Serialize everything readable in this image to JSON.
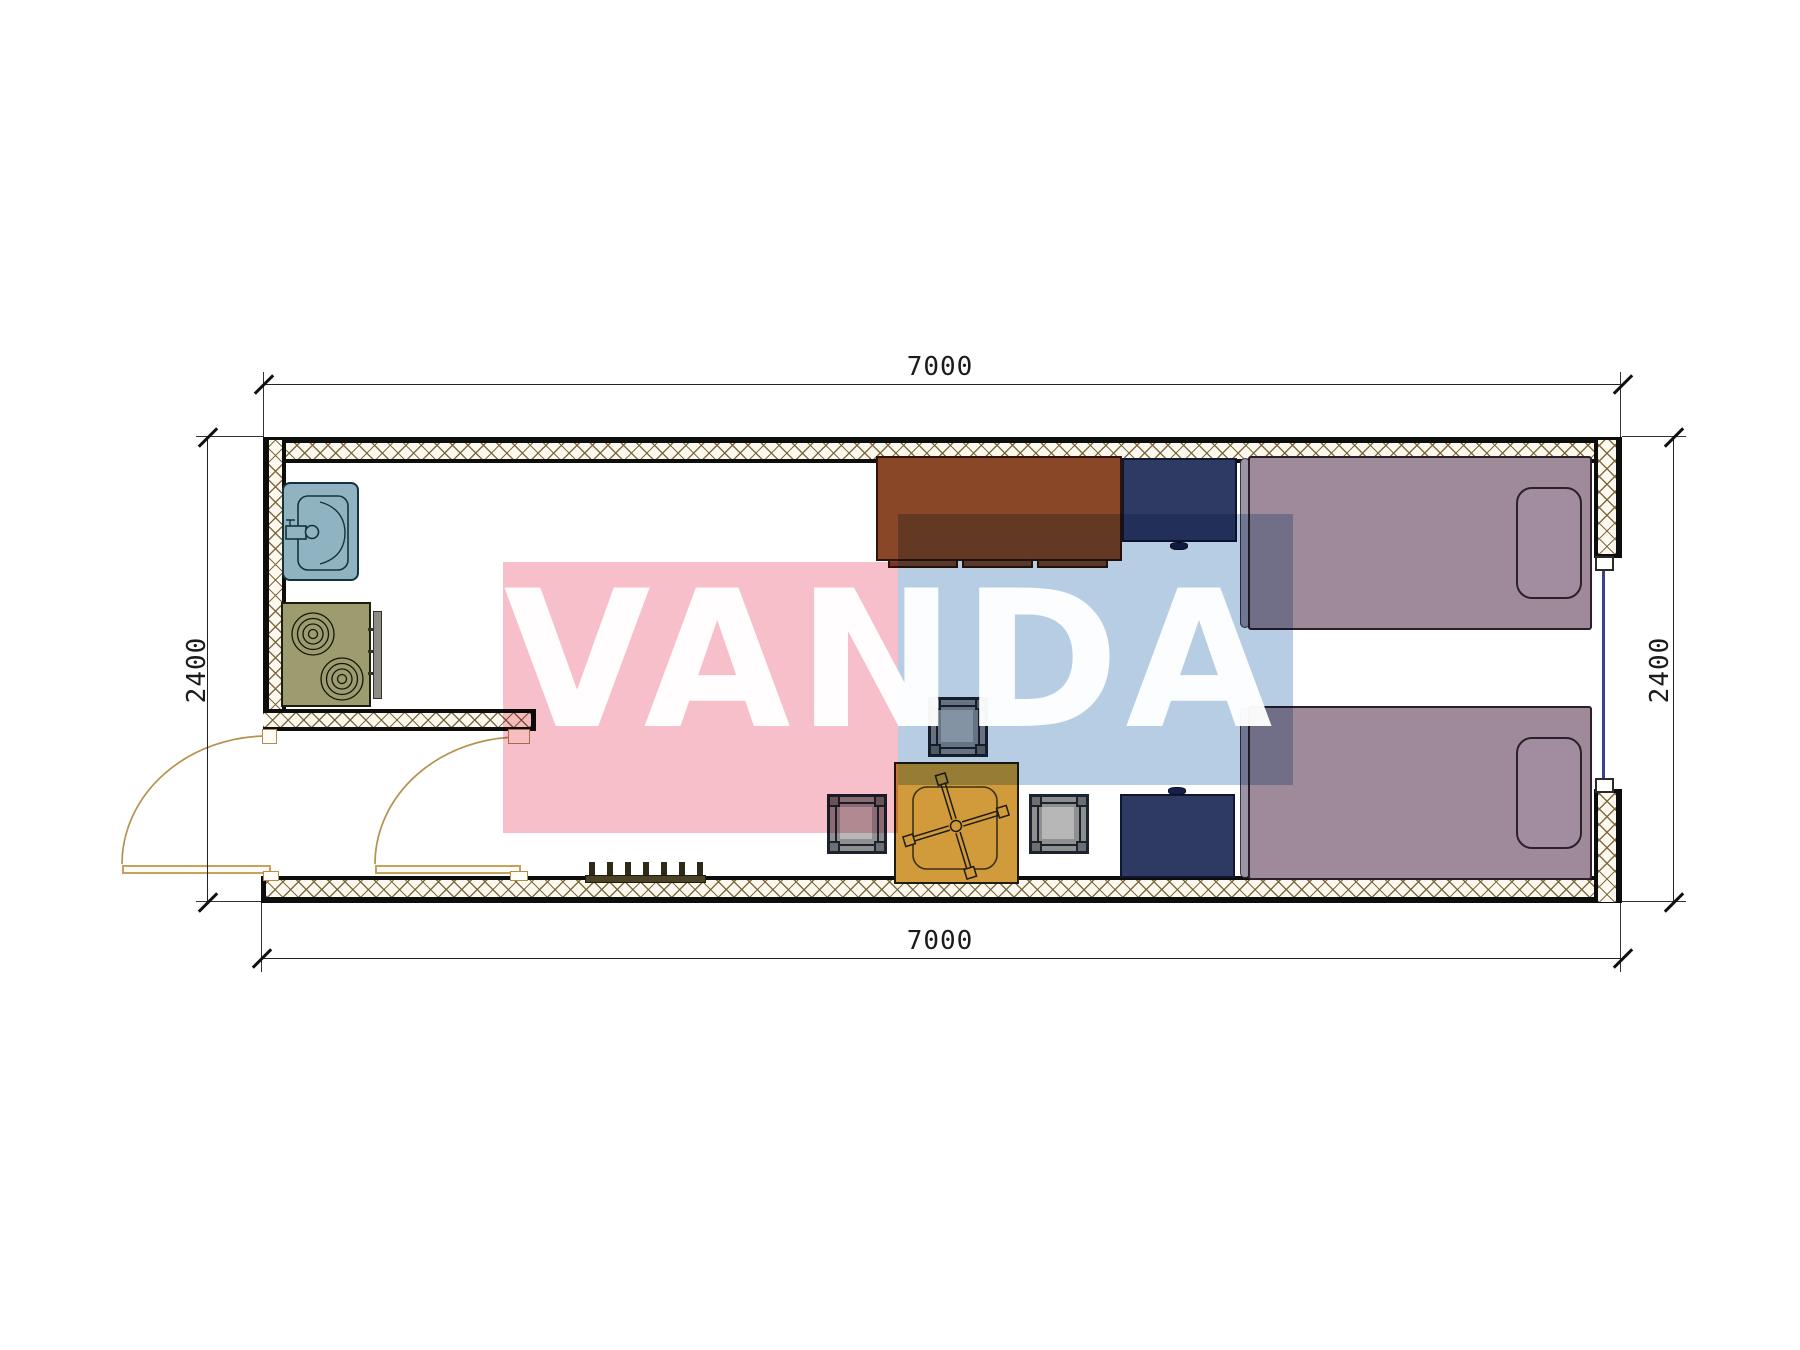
{
  "drawing": {
    "type": "floor-plan",
    "watermark": {
      "text": "VANDA",
      "pink_block": "#f6bfca",
      "blue_block": "#b7cde4",
      "letter_color": "#ffffff"
    },
    "dimensions": {
      "top": "7000",
      "bottom": "7000",
      "left": "2400",
      "right": "2400"
    },
    "window": {
      "glazing_color": "#3a3f8f"
    },
    "furniture_colors": {
      "sink": "#8fb3c0",
      "stove": "#9c9c6e",
      "desk": "#8a4727",
      "nightstand": "#2f3a62",
      "bed": "#9e8a98",
      "tea_table": "#d19a3b",
      "stool": "#8f8f8f",
      "coat_rack": "#4a4226",
      "door": "#c7a25c",
      "wall_hatch_line": "#78643a"
    }
  }
}
